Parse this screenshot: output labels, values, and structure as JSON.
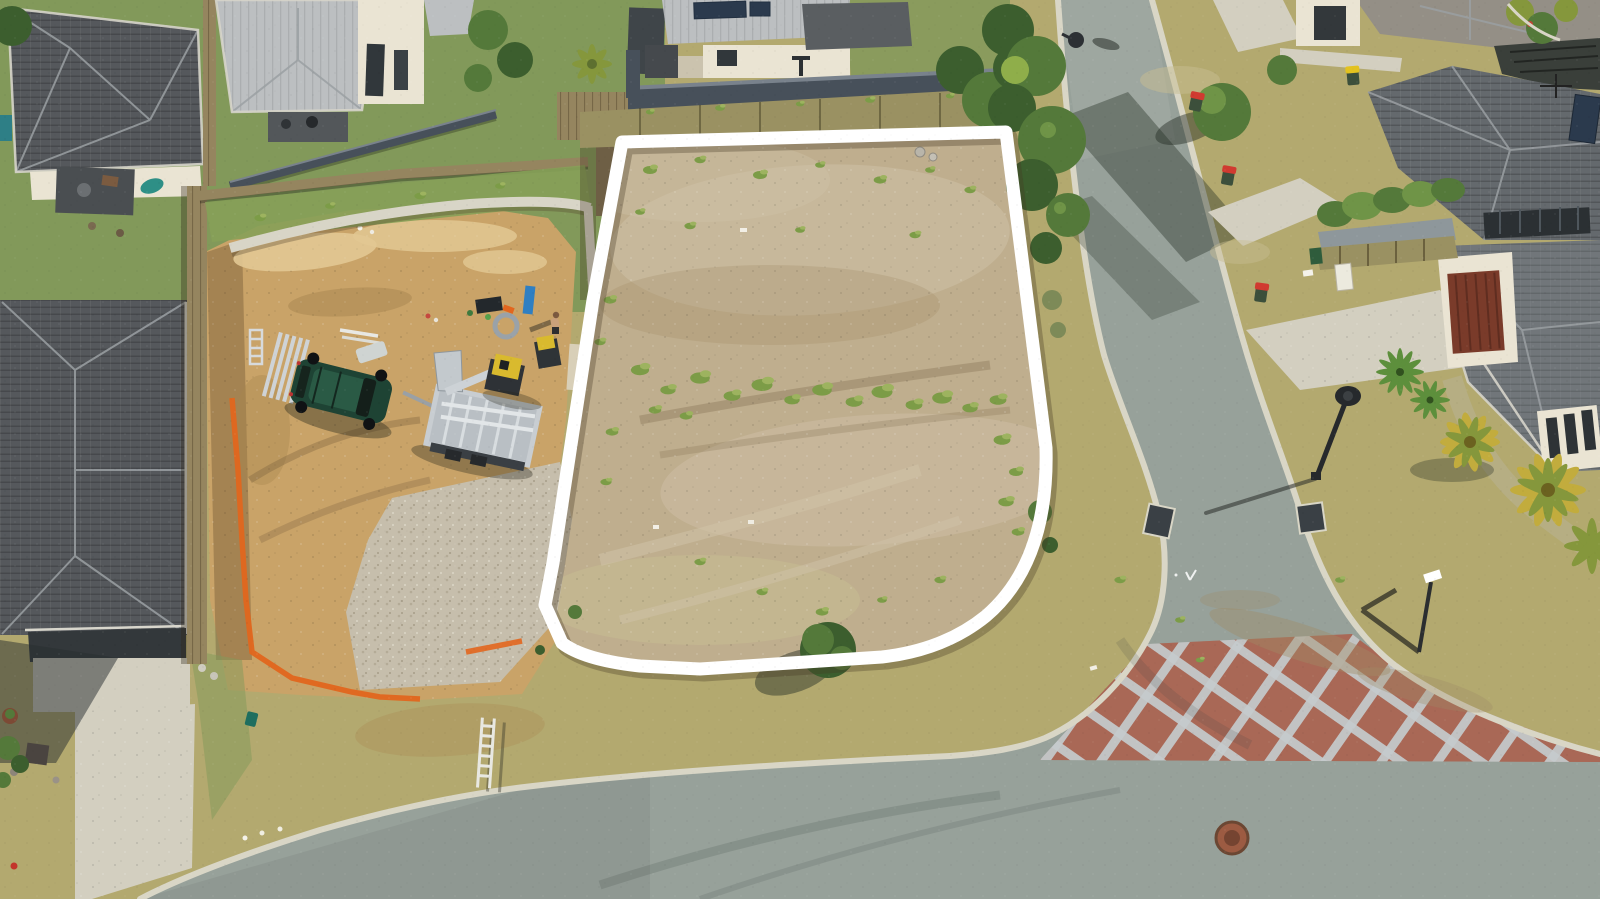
{
  "meta": {
    "type": "aerial-drone-photograph",
    "subject": "Aerial view of a vacant residential land lot outlined in white, beside a construction site and suburban streets",
    "setting": "new suburban housing estate, sunny day, top-down drone view"
  },
  "overlay": {
    "boundary_color": "#ffffff",
    "boundary_shape": "four-sided lot outline with large rounded street corner",
    "boundary_stroke_px": 13
  },
  "objects": {
    "vacant_lot": "cleared dirt lot with scattered green weeds",
    "construction_site": "excavated neighbouring lot with retaining walls, gravel pad and silt fencing",
    "vehicles": [
      "dark-green-suv-with-open-door",
      "aluminium-box-trailer",
      "yellow-compactor",
      "yellow-mini-loader"
    ],
    "people": [
      "worker-standing-on-site"
    ],
    "roads": [
      "side-street-running-top-to-bottom",
      "main-street-across-bottom",
      "red-brick-crosshatch-traffic-threshold"
    ],
    "street_furniture": [
      "street-light-curved-pole",
      "street-light-top",
      "street-sign",
      "stormwater-pits",
      "manhole-cover",
      "wheelie-bins-red-lids",
      "wheelie-bin-yellow-lid"
    ],
    "houses": [
      "dark-tile-roof-house-top-left",
      "light-metal-roof-house-top-center",
      "solar-panel-house-top-middle",
      "dark-roof-house-bottom-left",
      "grey-roof-houses-right",
      "red-garage-door-house-right"
    ],
    "vegetation": [
      "gum-trees-over-road",
      "street-tree",
      "verge-tree",
      "palm-clusters",
      "yucca-plants",
      "garden-hedge-row",
      "banana-plants-top-right"
    ]
  },
  "colors": {
    "grassGreen": "#82995a",
    "grassDry": "#b3a96f",
    "grassWorn": "#c8bd92",
    "dirtLot": "#bfae8e",
    "dirtLotLight": "#d0c2a8",
    "dirtLotDark": "#a08c66",
    "weedGreen": "#7c9c47",
    "weedLight": "#9db35f",
    "dirtSite": "#c9a368",
    "dirtSiteLight": "#e2c893",
    "dirtSiteDark": "#a8854f",
    "gravel": "#c6beac",
    "asphalt": "#97a19a",
    "asphaltLight": "#a6aea5",
    "curb": "#d9d6c6",
    "brickRed": "#b14f39",
    "brickLine": "#d8dde2",
    "roofDark": "#55585c",
    "roofLight": "#bcbfc1",
    "roofMid": "#64696d",
    "roofMid2": "#71767a",
    "roofTan": "#948f86",
    "ridge": "#9ba0a3",
    "wallCream": "#eae4d3",
    "windowDark": "#2e3336",
    "fenceDark": "#47505a",
    "timber": "#95855f",
    "retainKhaki": "#9a9162",
    "retainLight": "#d8d5c7",
    "treeDark": "#3c5e2e",
    "treeMid": "#54793a",
    "treeLight": "#6f9447",
    "shadow": "rgba(35,45,35,0.45)",
    "orange": "#e2661e",
    "suvGreen": "#1e4334",
    "trailerSilver": "#c8cdd1",
    "yellowMachine": "#d9ba2e",
    "palmYellow": "#c2ac3d",
    "palmGreen": "#85973c",
    "yucca": "#5d8f3c",
    "pathKhaki": "#b6ae83",
    "concrete": "#d3cfc0",
    "binRed": "#d03a30",
    "binYellow": "#e3c21f",
    "binBody": "#3c4f3b",
    "manhole": "#9c5b42",
    "pit": "#3a4045",
    "garageRed": "#7a3b2a"
  }
}
